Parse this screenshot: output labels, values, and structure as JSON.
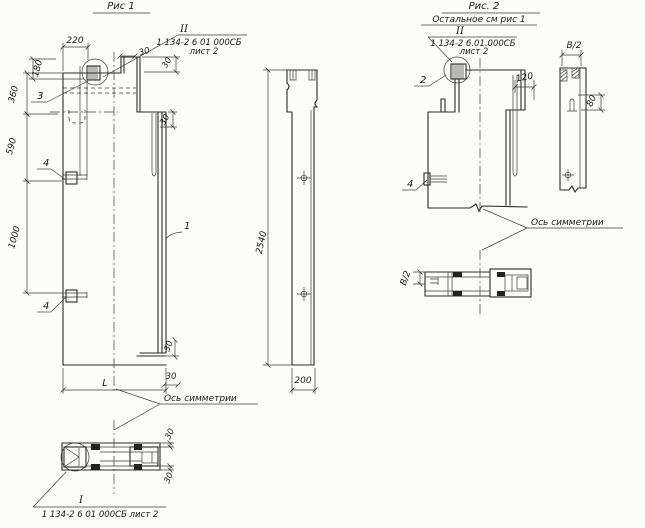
{
  "fig1": {
    "title": "Рис 1",
    "callout_top": {
      "numeral": "II",
      "doc_number": "1 134-2 6 01 000СБ",
      "sheet": "лист 2"
    },
    "dims": {
      "d220": "220",
      "d180": "180",
      "d360": "360",
      "d590": "590",
      "d1000": "1000",
      "d30": "30",
      "dL": "L",
      "d2540": "2540",
      "d200": "200"
    },
    "parts": {
      "p1": "1",
      "p3": "3",
      "p4": "4"
    },
    "axis_label": "Ось симметрии",
    "section_callout": {
      "numeral": "I",
      "doc_number": "1 134-2 6 01 000СБ лист 2",
      "d30": "30"
    }
  },
  "fig2": {
    "title": "Рис. 2",
    "note": "Остальное см рис 1",
    "callout_top": {
      "numeral": "II",
      "doc_number": "1 134-2 6.01.000СБ",
      "sheet": "лист 2"
    },
    "dims": {
      "d120": "120",
      "dB2": "В/2",
      "d80": "80"
    },
    "parts": {
      "p2": "2",
      "p4": "4"
    },
    "axis_label": "Ось симметрии"
  }
}
